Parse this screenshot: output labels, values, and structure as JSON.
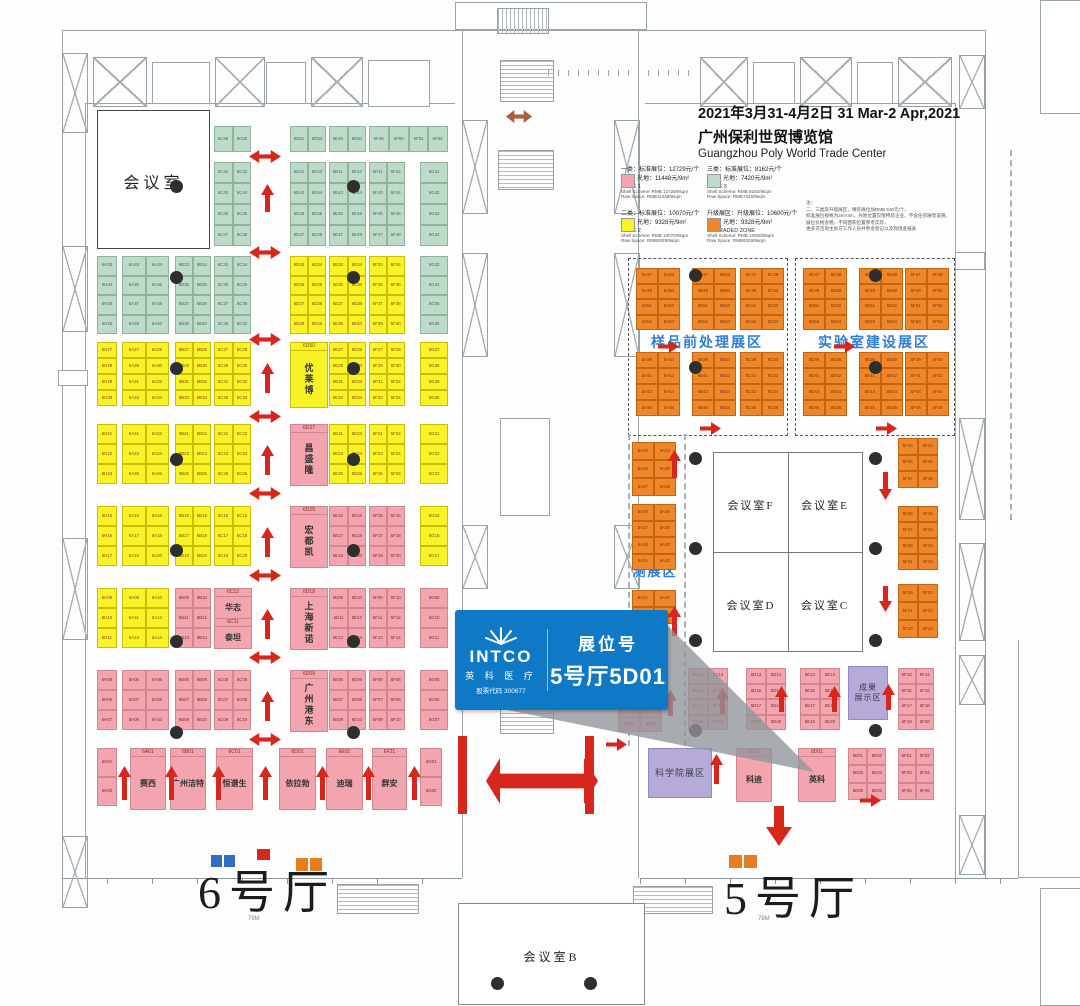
{
  "header": {
    "date_line": "2021年3月31-4月2日  31 Mar-2 Apr,2021",
    "venue_zh": "广州保利世贸博览馆",
    "venue_en": "Guangzhou Poly World Trade Center"
  },
  "legend": {
    "entries": [
      {
        "zh1": "一类：标准展位：12729元/个",
        "zh2": "光地：11448元/9m²",
        "zone": "ZONE 1",
        "en1": "Shell Scheme: RMB 12729/9sqm",
        "en2": "Raw Space: RMB11448/9sqm",
        "color": "#f2a5ae"
      },
      {
        "zh1": "三类：标准展位：8162元/个",
        "zh2": "光地：7420元/9m²",
        "zone": "ZONE 3",
        "en1": "Shell Scheme: RMB 8162/9sqm",
        "en2": "Raw Space: RMB7420/9sqm",
        "color": "#bedbc9"
      },
      {
        "zh1": "二类：标准展位：10070元/个",
        "zh2": "光地：9328元/9m²",
        "zone": "ZONE 2",
        "en1": "Shell Scheme: RMB 10070/9sqm",
        "en2": "Raw Space: RMB9328/9sqm",
        "color": "#f8f326"
      },
      {
        "zh1": "升级展区：升级展位：10600元/个",
        "zh2": "光地：9328元/9m²",
        "zone": "UPGRADED ZONE",
        "en1": "Shell Scheme: RMB 10600/9sqm",
        "en2": "Raw Space: RMB9328/9sqm",
        "color": "#ef8629"
      }
    ],
    "note_title": "注：",
    "note_lines": [
      "二、三类及升级展区，精装展位加RMB 530元/个，",
      "标准展位规格为3m×3m，光地位置仅限特装企业，不含任何展架设施，",
      "展位价格含税，不同面积位置参考实际，",
      "更多可咨询主办方工作人员并参会登记以及现场查核表"
    ]
  },
  "halls": {
    "hall6": "6号厅",
    "hall5": "5号厅",
    "dim6": "79M",
    "dim5": "79M"
  },
  "rooms": {
    "meeting_main": "会议室",
    "meeting_b": "会议室B",
    "meeting_c": "会议室C",
    "meeting_d": "会议室D",
    "meeting_e": "会议室E",
    "meeting_f": "会议室F"
  },
  "zones": {
    "sample_prep": "样品前处理展区",
    "lab_build": "实验室建设展区",
    "env1": "环境监",
    "env2": "测展区",
    "ach1": "成果",
    "ach2": "展示区",
    "academy": "科学院展区"
  },
  "callout": {
    "brand": "INTCO",
    "brand_zh": "英 科 医 疗",
    "stock": "股票代码 300677",
    "booth_label": "展位号",
    "booth_no": "5号厅5D01",
    "accent": "#0f79c6"
  },
  "colors": {
    "arrow": "#d7271d",
    "arrow_brown": "#a8613c",
    "zone_label": "#2f7fd6"
  },
  "groups": [
    {
      "x": 214,
      "y": 126,
      "w": 37,
      "h": 26,
      "c": "g",
      "n": 2,
      "r": 1,
      "p": "6C",
      "s": 49
    },
    {
      "x": 290,
      "y": 126,
      "w": 36,
      "h": 26,
      "c": "g",
      "n": 2,
      "r": 1,
      "p": "6D",
      "s": 51
    },
    {
      "x": 329,
      "y": 126,
      "w": 37,
      "h": 26,
      "c": "g",
      "n": 2,
      "r": 1,
      "p": "6E",
      "s": 49
    },
    {
      "x": 369,
      "y": 126,
      "w": 79,
      "h": 26,
      "c": "g",
      "n": 4,
      "r": 1,
      "p": "6F",
      "s": 49
    },
    {
      "x": 214,
      "y": 162,
      "w": 37,
      "h": 84,
      "c": "g",
      "n": 2,
      "r": 4,
      "p": "6C",
      "s": 41
    },
    {
      "x": 290,
      "y": 162,
      "w": 36,
      "h": 84,
      "c": "g",
      "n": 2,
      "r": 4,
      "p": "6D",
      "s": 41
    },
    {
      "x": 329,
      "y": 162,
      "w": 37,
      "h": 84,
      "c": "g",
      "n": 2,
      "r": 4,
      "p": "6E",
      "s": 41
    },
    {
      "x": 369,
      "y": 162,
      "w": 36,
      "h": 84,
      "c": "g",
      "n": 2,
      "r": 4,
      "p": "6F",
      "s": 41
    },
    {
      "x": 420,
      "y": 162,
      "w": 28,
      "h": 84,
      "c": "g",
      "n": 1,
      "r": 4,
      "p": "6G",
      "s": 41
    },
    {
      "x": 97,
      "y": 256,
      "w": 20,
      "h": 78,
      "c": "g",
      "n": 1,
      "r": 4,
      "p": "6H",
      "s": 33
    },
    {
      "x": 122,
      "y": 256,
      "w": 47,
      "h": 78,
      "c": "g",
      "n": 2,
      "r": 4,
      "p": "6A",
      "s": 33
    },
    {
      "x": 175,
      "y": 256,
      "w": 36,
      "h": 78,
      "c": "g",
      "n": 2,
      "r": 4,
      "p": "6B",
      "s": 33
    },
    {
      "x": 214,
      "y": 256,
      "w": 37,
      "h": 78,
      "c": "g",
      "n": 2,
      "r": 4,
      "p": "6C",
      "s": 33
    },
    {
      "x": 290,
      "y": 256,
      "w": 36,
      "h": 78,
      "c": "y",
      "n": 2,
      "r": 4,
      "p": "6D",
      "s": 33
    },
    {
      "x": 329,
      "y": 256,
      "w": 37,
      "h": 78,
      "c": "y",
      "n": 2,
      "r": 4,
      "p": "6E",
      "s": 33
    },
    {
      "x": 369,
      "y": 256,
      "w": 36,
      "h": 78,
      "c": "y",
      "n": 2,
      "r": 4,
      "p": "6F",
      "s": 33
    },
    {
      "x": 420,
      "y": 256,
      "w": 28,
      "h": 78,
      "c": "g",
      "n": 1,
      "r": 4,
      "p": "6G",
      "s": 33
    },
    {
      "x": 97,
      "y": 342,
      "w": 20,
      "h": 64,
      "c": "y",
      "n": 1,
      "r": 4,
      "p": "6H",
      "s": 27
    },
    {
      "x": 122,
      "y": 342,
      "w": 47,
      "h": 64,
      "c": "y",
      "n": 2,
      "r": 4,
      "p": "6A",
      "s": 27
    },
    {
      "x": 175,
      "y": 342,
      "w": 36,
      "h": 64,
      "c": "y",
      "n": 2,
      "r": 4,
      "p": "6B",
      "s": 27
    },
    {
      "x": 214,
      "y": 342,
      "w": 37,
      "h": 64,
      "c": "y",
      "n": 2,
      "r": 4,
      "p": "6C",
      "s": 27
    },
    {
      "x": 290,
      "y": 342,
      "w": 36,
      "h": 64,
      "c": "y",
      "code": "6D50",
      "name": "优莱博"
    },
    {
      "x": 329,
      "y": 342,
      "w": 37,
      "h": 64,
      "c": "y",
      "n": 2,
      "r": 4,
      "p": "6E",
      "s": 27
    },
    {
      "x": 369,
      "y": 342,
      "w": 36,
      "h": 64,
      "c": "y",
      "n": 2,
      "r": 4,
      "p": "6F",
      "s": 27
    },
    {
      "x": 420,
      "y": 342,
      "w": 28,
      "h": 64,
      "c": "y",
      "n": 1,
      "r": 4,
      "p": "6G",
      "s": 27
    },
    {
      "x": 97,
      "y": 424,
      "w": 20,
      "h": 60,
      "c": "y",
      "n": 1,
      "r": 3,
      "p": "6H",
      "s": 21
    },
    {
      "x": 122,
      "y": 424,
      "w": 47,
      "h": 60,
      "c": "y",
      "n": 2,
      "r": 3,
      "p": "6A",
      "s": 21
    },
    {
      "x": 175,
      "y": 424,
      "w": 36,
      "h": 60,
      "c": "y",
      "n": 2,
      "r": 3,
      "p": "6B",
      "s": 21
    },
    {
      "x": 214,
      "y": 424,
      "w": 37,
      "h": 60,
      "c": "y",
      "n": 2,
      "r": 3,
      "p": "6C",
      "s": 21
    },
    {
      "x": 290,
      "y": 424,
      "w": 36,
      "h": 60,
      "c": "p",
      "code": "6D37",
      "name": "昌盛隆"
    },
    {
      "x": 329,
      "y": 424,
      "w": 37,
      "h": 60,
      "c": "y",
      "n": 2,
      "r": 3,
      "p": "6E",
      "s": 21
    },
    {
      "x": 369,
      "y": 424,
      "w": 36,
      "h": 60,
      "c": "y",
      "n": 2,
      "r": 3,
      "p": "6F",
      "s": 21
    },
    {
      "x": 420,
      "y": 424,
      "w": 28,
      "h": 60,
      "c": "y",
      "n": 1,
      "r": 3,
      "p": "6G",
      "s": 21
    },
    {
      "x": 97,
      "y": 506,
      "w": 20,
      "h": 60,
      "c": "y",
      "n": 1,
      "r": 3,
      "p": "6H",
      "s": 15
    },
    {
      "x": 122,
      "y": 506,
      "w": 47,
      "h": 60,
      "c": "y",
      "n": 2,
      "r": 3,
      "p": "6A",
      "s": 15
    },
    {
      "x": 175,
      "y": 506,
      "w": 36,
      "h": 60,
      "c": "y",
      "n": 2,
      "r": 3,
      "p": "6B",
      "s": 15
    },
    {
      "x": 214,
      "y": 506,
      "w": 37,
      "h": 60,
      "c": "y",
      "n": 2,
      "r": 3,
      "p": "6C",
      "s": 15
    },
    {
      "x": 290,
      "y": 506,
      "w": 36,
      "h": 60,
      "c": "p",
      "code": "6D25",
      "name": "宏都凯"
    },
    {
      "x": 329,
      "y": 506,
      "w": 37,
      "h": 60,
      "c": "p",
      "n": 2,
      "r": 3,
      "p": "6E",
      "s": 15
    },
    {
      "x": 369,
      "y": 506,
      "w": 36,
      "h": 60,
      "c": "p",
      "n": 2,
      "r": 3,
      "p": "6F",
      "s": 15
    },
    {
      "x": 420,
      "y": 506,
      "w": 28,
      "h": 60,
      "c": "y",
      "n": 1,
      "r": 3,
      "p": "6G",
      "s": 15
    },
    {
      "x": 97,
      "y": 588,
      "w": 20,
      "h": 60,
      "c": "y",
      "n": 1,
      "r": 3,
      "p": "6H",
      "s": 9
    },
    {
      "x": 122,
      "y": 588,
      "w": 47,
      "h": 60,
      "c": "y",
      "n": 2,
      "r": 3,
      "p": "6A",
      "s": 9
    },
    {
      "x": 175,
      "y": 588,
      "w": 36,
      "h": 60,
      "c": "p",
      "n": 2,
      "r": 3,
      "p": "6B",
      "s": 9
    },
    {
      "x": 214,
      "y": 588,
      "w": 37,
      "h": 60,
      "c": "p",
      "pairs": [
        [
          "6C12",
          "华志"
        ],
        [
          "6C11",
          "泰坦"
        ]
      ]
    },
    {
      "x": 290,
      "y": 588,
      "w": 36,
      "h": 60,
      "c": "p",
      "code": "6D18",
      "name": "上海新诺"
    },
    {
      "x": 329,
      "y": 588,
      "w": 37,
      "h": 60,
      "c": "p",
      "n": 2,
      "r": 3,
      "p": "6E",
      "s": 9
    },
    {
      "x": 369,
      "y": 588,
      "w": 36,
      "h": 60,
      "c": "p",
      "n": 2,
      "r": 3,
      "p": "6F",
      "s": 9
    },
    {
      "x": 420,
      "y": 588,
      "w": 28,
      "h": 60,
      "c": "p",
      "n": 1,
      "r": 3,
      "p": "6G",
      "s": 9
    },
    {
      "x": 97,
      "y": 670,
      "w": 20,
      "h": 60,
      "c": "p",
      "n": 1,
      "r": 3,
      "p": "6H",
      "s": 5
    },
    {
      "x": 122,
      "y": 670,
      "w": 47,
      "h": 60,
      "c": "p",
      "n": 2,
      "r": 3,
      "p": "6A",
      "s": 5
    },
    {
      "x": 175,
      "y": 670,
      "w": 36,
      "h": 60,
      "c": "p",
      "n": 2,
      "r": 3,
      "p": "6B",
      "s": 5
    },
    {
      "x": 214,
      "y": 670,
      "w": 37,
      "h": 60,
      "c": "p",
      "n": 2,
      "r": 3,
      "p": "6C",
      "s": 5
    },
    {
      "x": 290,
      "y": 670,
      "w": 36,
      "h": 60,
      "c": "p",
      "code": "6D09",
      "name": "广州港东"
    },
    {
      "x": 329,
      "y": 670,
      "w": 37,
      "h": 60,
      "c": "p",
      "n": 2,
      "r": 3,
      "p": "6E",
      "s": 5
    },
    {
      "x": 369,
      "y": 670,
      "w": 36,
      "h": 60,
      "c": "p",
      "n": 2,
      "r": 3,
      "p": "6F",
      "s": 5
    },
    {
      "x": 420,
      "y": 670,
      "w": 28,
      "h": 60,
      "c": "p",
      "n": 1,
      "r": 3,
      "p": "6G",
      "s": 5
    },
    {
      "x": 97,
      "y": 748,
      "w": 20,
      "h": 58,
      "c": "p",
      "n": 1,
      "r": 2,
      "p": "6H",
      "s": 1
    },
    {
      "x": 130,
      "y": 748,
      "w": 34,
      "h": 60,
      "c": "p",
      "code": "6A01",
      "name": "赛西",
      "hn": true
    },
    {
      "x": 170,
      "y": 748,
      "w": 34,
      "h": 60,
      "c": "p",
      "code": "6B01",
      "name": "广州洁特",
      "hn": true
    },
    {
      "x": 216,
      "y": 748,
      "w": 35,
      "h": 60,
      "c": "p",
      "code": "6C01",
      "name": "恒谱生",
      "hn": true
    },
    {
      "x": 279,
      "y": 748,
      "w": 35,
      "h": 60,
      "c": "p",
      "code": "6D01",
      "name": "依拉勃",
      "hn": true
    },
    {
      "x": 326,
      "y": 748,
      "w": 35,
      "h": 60,
      "c": "p",
      "code": "6E01",
      "name": "迪瑞",
      "hn": true
    },
    {
      "x": 372,
      "y": 748,
      "w": 33,
      "h": 60,
      "c": "p",
      "code": "6F21",
      "name": "群安",
      "hn": true
    },
    {
      "x": 420,
      "y": 748,
      "w": 22,
      "h": 58,
      "c": "p",
      "n": 1,
      "r": 2,
      "p": "6G",
      "s": 1
    },
    {
      "x": 636,
      "y": 268,
      "w": 44,
      "h": 62,
      "c": "o",
      "n": 2,
      "r": 4,
      "p": "5A",
      "s": 47
    },
    {
      "x": 692,
      "y": 268,
      "w": 44,
      "h": 62,
      "c": "o",
      "n": 2,
      "r": 4,
      "p": "5B",
      "s": 47
    },
    {
      "x": 740,
      "y": 268,
      "w": 44,
      "h": 62,
      "c": "o",
      "n": 2,
      "r": 4,
      "p": "5C",
      "s": 47
    },
    {
      "x": 636,
      "y": 352,
      "w": 44,
      "h": 64,
      "c": "o",
      "n": 2,
      "r": 4,
      "p": "5A",
      "s": 39
    },
    {
      "x": 692,
      "y": 352,
      "w": 44,
      "h": 64,
      "c": "o",
      "n": 2,
      "r": 4,
      "p": "5B",
      "s": 39
    },
    {
      "x": 740,
      "y": 352,
      "w": 44,
      "h": 64,
      "c": "o",
      "n": 2,
      "r": 4,
      "p": "5C",
      "s": 39
    },
    {
      "x": 803,
      "y": 268,
      "w": 44,
      "h": 62,
      "c": "o",
      "n": 2,
      "r": 4,
      "p": "5D",
      "s": 47
    },
    {
      "x": 859,
      "y": 268,
      "w": 44,
      "h": 62,
      "c": "o",
      "n": 2,
      "r": 4,
      "p": "5E",
      "s": 47
    },
    {
      "x": 905,
      "y": 268,
      "w": 44,
      "h": 62,
      "c": "o",
      "n": 2,
      "r": 4,
      "p": "5F",
      "s": 47
    },
    {
      "x": 803,
      "y": 352,
      "w": 44,
      "h": 64,
      "c": "o",
      "n": 2,
      "r": 4,
      "p": "5D",
      "s": 39
    },
    {
      "x": 859,
      "y": 352,
      "w": 44,
      "h": 64,
      "c": "o",
      "n": 2,
      "r": 4,
      "p": "5E",
      "s": 39
    },
    {
      "x": 905,
      "y": 352,
      "w": 44,
      "h": 64,
      "c": "o",
      "n": 2,
      "r": 4,
      "p": "5F",
      "s": 39
    },
    {
      "x": 632,
      "y": 442,
      "w": 44,
      "h": 54,
      "c": "o",
      "n": 2,
      "r": 3,
      "p": "5A",
      "s": 33
    },
    {
      "x": 632,
      "y": 504,
      "w": 44,
      "h": 66,
      "c": "o",
      "n": 2,
      "r": 4,
      "p": "5A",
      "s": 25
    },
    {
      "x": 632,
      "y": 590,
      "w": 44,
      "h": 34,
      "c": "o",
      "n": 2,
      "r": 2,
      "p": "5A",
      "s": 21
    },
    {
      "x": 898,
      "y": 438,
      "w": 40,
      "h": 50,
      "c": "o",
      "n": 2,
      "r": 3,
      "p": "5F",
      "s": 33
    },
    {
      "x": 898,
      "y": 506,
      "w": 40,
      "h": 64,
      "c": "o",
      "n": 2,
      "r": 4,
      "p": "5F",
      "s": 25
    },
    {
      "x": 898,
      "y": 584,
      "w": 40,
      "h": 54,
      "c": "o",
      "n": 2,
      "r": 3,
      "p": "5F",
      "s": 19
    },
    {
      "x": 688,
      "y": 668,
      "w": 40,
      "h": 62,
      "c": "p",
      "n": 2,
      "r": 4,
      "p": "5C",
      "s": 13
    },
    {
      "x": 746,
      "y": 668,
      "w": 40,
      "h": 62,
      "c": "p",
      "n": 2,
      "r": 4,
      "p": "5D",
      "s": 13
    },
    {
      "x": 800,
      "y": 668,
      "w": 40,
      "h": 62,
      "c": "p",
      "n": 2,
      "r": 4,
      "p": "5E",
      "s": 13
    },
    {
      "x": 898,
      "y": 668,
      "w": 36,
      "h": 62,
      "c": "p",
      "n": 2,
      "r": 4,
      "p": "5F",
      "s": 13
    },
    {
      "x": 618,
      "y": 702,
      "w": 44,
      "h": 30,
      "c": "p",
      "n": 2,
      "r": 2,
      "p": "5B",
      "s": 9
    },
    {
      "x": 736,
      "y": 748,
      "w": 34,
      "h": 52,
      "c": "p",
      "code": "5C01",
      "name": "科迪",
      "hn": true
    },
    {
      "x": 798,
      "y": 748,
      "w": 36,
      "h": 52,
      "c": "p",
      "code": "5D01",
      "name": "英科",
      "hn": true
    },
    {
      "x": 848,
      "y": 748,
      "w": 38,
      "h": 52,
      "c": "p",
      "n": 2,
      "r": 3,
      "p": "5E",
      "s": 1
    },
    {
      "x": 898,
      "y": 748,
      "w": 36,
      "h": 52,
      "c": "p",
      "n": 2,
      "r": 3,
      "p": "5F",
      "s": 1
    }
  ],
  "pillars": [
    [
      176,
      186
    ],
    [
      353,
      186
    ],
    [
      176,
      277
    ],
    [
      353,
      277
    ],
    [
      176,
      368
    ],
    [
      353,
      368
    ],
    [
      176,
      459
    ],
    [
      353,
      459
    ],
    [
      176,
      550
    ],
    [
      353,
      550
    ],
    [
      176,
      641
    ],
    [
      353,
      641
    ],
    [
      176,
      732
    ],
    [
      353,
      732
    ],
    [
      695,
      275
    ],
    [
      875,
      275
    ],
    [
      695,
      367
    ],
    [
      875,
      367
    ],
    [
      695,
      458
    ],
    [
      875,
      458
    ],
    [
      695,
      548
    ],
    [
      875,
      548
    ],
    [
      695,
      640
    ],
    [
      875,
      640
    ],
    [
      695,
      730
    ],
    [
      875,
      730
    ],
    [
      497,
      983
    ],
    [
      590,
      983
    ]
  ],
  "arrows": [
    {
      "t": "h2",
      "x": 249,
      "y": 150
    },
    {
      "t": "h2",
      "x": 249,
      "y": 246
    },
    {
      "t": "h2",
      "x": 249,
      "y": 333
    },
    {
      "t": "h2",
      "x": 249,
      "y": 410
    },
    {
      "t": "h2",
      "x": 249,
      "y": 487
    },
    {
      "t": "h2",
      "x": 249,
      "y": 569
    },
    {
      "t": "h2",
      "x": 249,
      "y": 651
    },
    {
      "t": "h2",
      "x": 249,
      "y": 733
    },
    {
      "t": "up",
      "x": 261,
      "y": 184,
      "h": 28
    },
    {
      "t": "up",
      "x": 261,
      "y": 363,
      "h": 30
    },
    {
      "t": "up",
      "x": 261,
      "y": 445,
      "h": 30
    },
    {
      "t": "up",
      "x": 261,
      "y": 527,
      "h": 30
    },
    {
      "t": "up",
      "x": 261,
      "y": 609,
      "h": 30
    },
    {
      "t": "up",
      "x": 261,
      "y": 691,
      "h": 30
    },
    {
      "t": "up",
      "x": 118,
      "y": 766,
      "h": 34
    },
    {
      "t": "up",
      "x": 165,
      "y": 766,
      "h": 34
    },
    {
      "t": "up",
      "x": 212,
      "y": 766,
      "h": 34
    },
    {
      "t": "up",
      "x": 259,
      "y": 766,
      "h": 34
    },
    {
      "t": "up",
      "x": 316,
      "y": 766,
      "h": 34
    },
    {
      "t": "up",
      "x": 362,
      "y": 766,
      "h": 34
    },
    {
      "t": "up",
      "x": 408,
      "y": 766,
      "h": 34
    },
    {
      "t": "h2",
      "x": 506,
      "y": 110,
      "w": 26,
      "brown": true
    },
    {
      "t": "bar",
      "x": 458,
      "y": 736,
      "w": 9,
      "h": 78
    },
    {
      "t": "bar",
      "x": 585,
      "y": 736,
      "w": 9,
      "h": 78
    },
    {
      "t": "h2",
      "x": 486,
      "y": 758,
      "w": 112,
      "h": 46
    },
    {
      "t": "right",
      "x": 658,
      "y": 340
    },
    {
      "t": "right",
      "x": 700,
      "y": 422
    },
    {
      "t": "right",
      "x": 834,
      "y": 340
    },
    {
      "t": "right",
      "x": 876,
      "y": 422
    },
    {
      "t": "up",
      "x": 668,
      "y": 450,
      "h": 28
    },
    {
      "t": "up",
      "x": 668,
      "y": 606,
      "h": 30
    },
    {
      "t": "down",
      "x": 879,
      "y": 472,
      "h": 28
    },
    {
      "t": "down",
      "x": 879,
      "y": 586,
      "h": 26
    },
    {
      "t": "up",
      "x": 664,
      "y": 690,
      "h": 26
    },
    {
      "t": "up",
      "x": 716,
      "y": 688,
      "h": 26
    },
    {
      "t": "up",
      "x": 775,
      "y": 686,
      "h": 26
    },
    {
      "t": "up",
      "x": 828,
      "y": 686,
      "h": 26
    },
    {
      "t": "up",
      "x": 882,
      "y": 684,
      "h": 26
    },
    {
      "t": "up",
      "x": 710,
      "y": 754,
      "h": 30
    },
    {
      "t": "right",
      "x": 606,
      "y": 738
    },
    {
      "t": "right",
      "x": 860,
      "y": 794
    },
    {
      "t": "bigdown",
      "x": 766,
      "y": 806
    }
  ]
}
